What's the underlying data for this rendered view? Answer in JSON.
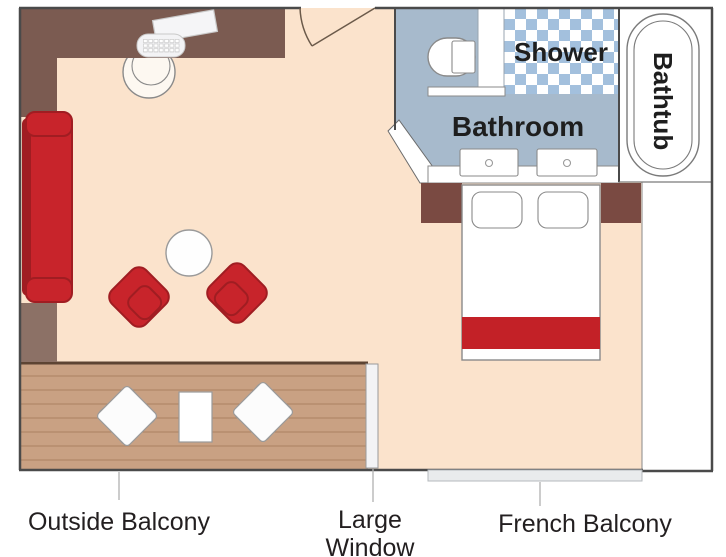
{
  "plan": {
    "type": "stateroom-floor-plan",
    "labels": {
      "shower": "Shower",
      "bathroom": "Bathroom",
      "bathtub": "Bathtub",
      "outside_balcony": "Outside Balcony",
      "large_window_line1": "Large",
      "large_window_line2": "Window",
      "french_balcony": "French Balcony"
    },
    "colors": {
      "floor": "#fbe3cc",
      "balcony_wood": "#c9a183",
      "balcony_wood_line": "#ab8160",
      "bathroom_floor": "#a7bacc",
      "shower_tile_blue": "#a3c0dd",
      "furniture_red": "#c8242b",
      "furniture_red_dark": "#a01d22",
      "desk_brown": "#7b5b51",
      "wall_taupe": "#8c7166",
      "nightstand_brown": "#7a4a42",
      "bed_blanket_red": "#c32127",
      "label_text": "#231f20",
      "wall_line": "#4a4a4a"
    }
  }
}
